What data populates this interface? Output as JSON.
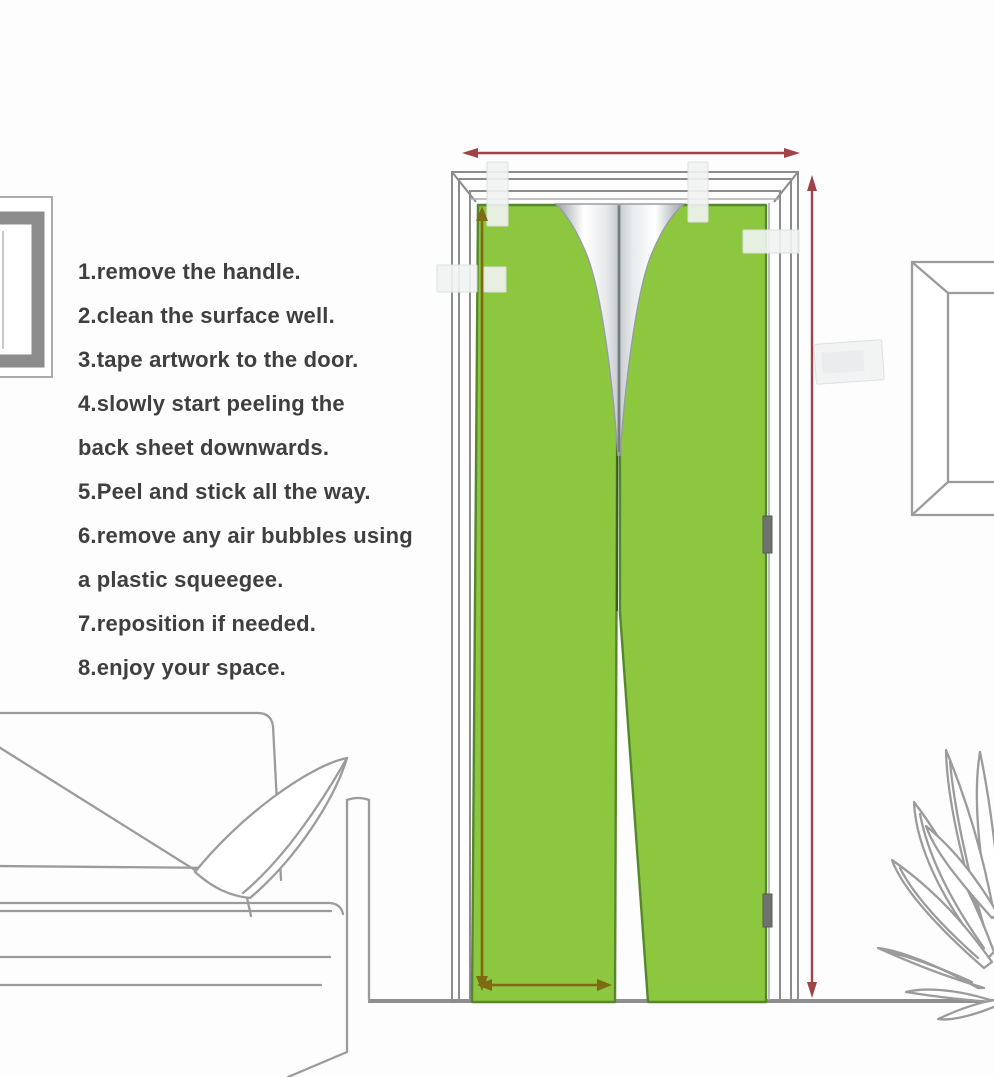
{
  "instructions": {
    "lines": [
      "1.remove the handle.",
      "2.clean the surface well.",
      "3.tape artwork to the door.",
      "4.slowly start peeling the",
      "back sheet downwards.",
      "5.Peel and stick all the way.",
      "6.remove any air bubbles using",
      "a plastic squeegee.",
      "7.reposition if needed.",
      "8.enjoy your space."
    ]
  },
  "colors": {
    "background": "#fdfdfd",
    "text_color": "#3f3f3f",
    "sticker_green": "#8dc63f",
    "sticker_green_dark": "#55882c",
    "seam_green_dark": "#3d5c20",
    "measure_red": "#a04248",
    "measure_olive": "#7d6a12",
    "outline_gray": "#9b9b9b",
    "frame_gray": "#8c8c8c",
    "floor_gray": "#8f8f8f",
    "tape_fill": "#f1f3f3",
    "hinge_gray": "#6e736e",
    "peel_dark": "#9aa0a6",
    "peel_light": "#ffffff"
  },
  "scene": {
    "description": "Installation diagram for a self-adhesive green door mural: door with two sticker panels peeling from the back sheet, red arrows marking door width and height, olive arrows marking panel size, masking tape pieces, sofa with pillow, two picture frames and a plant.",
    "parts": [
      "instruction-list",
      "picture-frame-left",
      "door-frame",
      "sticker-panel-left",
      "sticker-panel-right",
      "peeling-back-sheet",
      "masking-tapes",
      "door-width-arrow",
      "door-height-arrow",
      "panel-width-arrow",
      "panel-height-arrow",
      "door-hinges",
      "sofa",
      "pillow",
      "picture-frame-right",
      "plant",
      "floor-line"
    ]
  }
}
